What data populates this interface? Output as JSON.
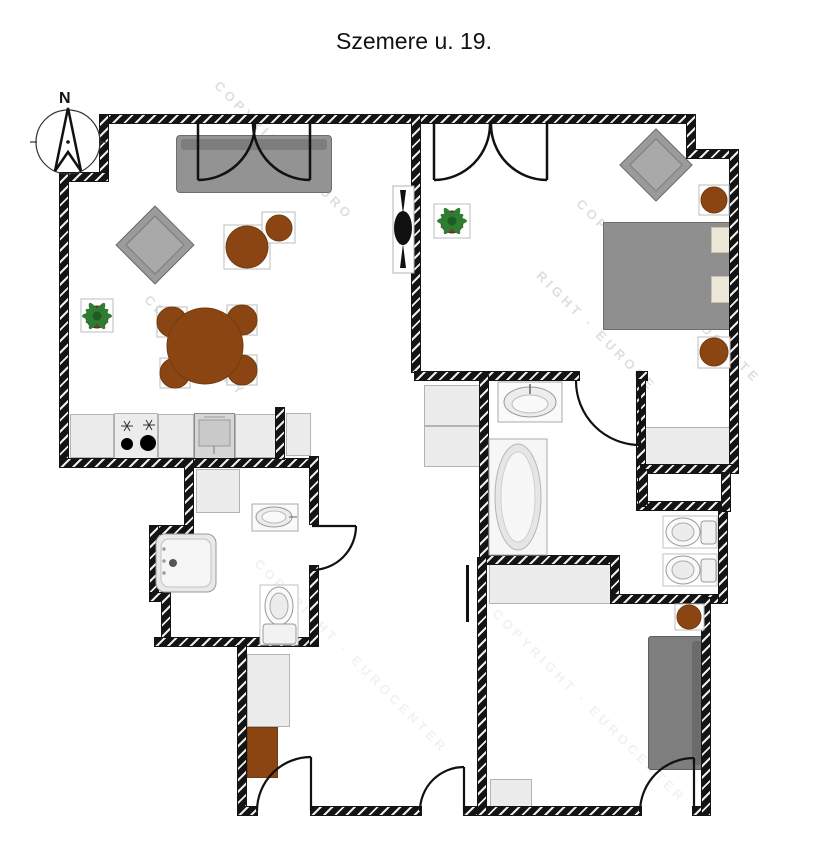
{
  "title": "Szemere u. 19.",
  "compass": {
    "label": "N",
    "icon": "north-arrow-icon"
  },
  "watermark": {
    "items": [
      {
        "text": "COPYRIGHT · EURO"
      },
      {
        "text": "CENTER COPY"
      },
      {
        "text": "COPYRIGHT · EUROCENTE"
      },
      {
        "text": "RIGHT · EUROCE"
      },
      {
        "text": "COPYRIGHT · EUROCENTER"
      },
      {
        "text": "COPYRIGHT · EUROCENTER"
      }
    ]
  },
  "colors": {
    "wall": "#141414",
    "furniture_gray": "#939393",
    "dark_sofa_gray": "#7e7e7e",
    "wood_brown": "#8B4513",
    "counter_gray": "#ececec",
    "fixture_white": "#f7f7f7",
    "plant_green": "#2f7d32",
    "watermark_gray": "#c4c4c4"
  },
  "fixtures": [
    {
      "name": "north-arrow-icon"
    },
    {
      "name": "double-french-door"
    },
    {
      "name": "sofa"
    },
    {
      "name": "armchair"
    },
    {
      "name": "coffee-table"
    },
    {
      "name": "side-table"
    },
    {
      "name": "dining-table"
    },
    {
      "name": "dining-chair"
    },
    {
      "name": "potted-plant-icon"
    },
    {
      "name": "tv-icon"
    },
    {
      "name": "kitchen-counter"
    },
    {
      "name": "stove-icon"
    },
    {
      "name": "kitchen-sink-icon"
    },
    {
      "name": "shower-icon"
    },
    {
      "name": "washbasin-icon"
    },
    {
      "name": "toilet-icon"
    },
    {
      "name": "bathtub-icon"
    },
    {
      "name": "double-bed"
    },
    {
      "name": "wardrobe"
    },
    {
      "name": "stool"
    },
    {
      "name": "door-swing"
    }
  ]
}
